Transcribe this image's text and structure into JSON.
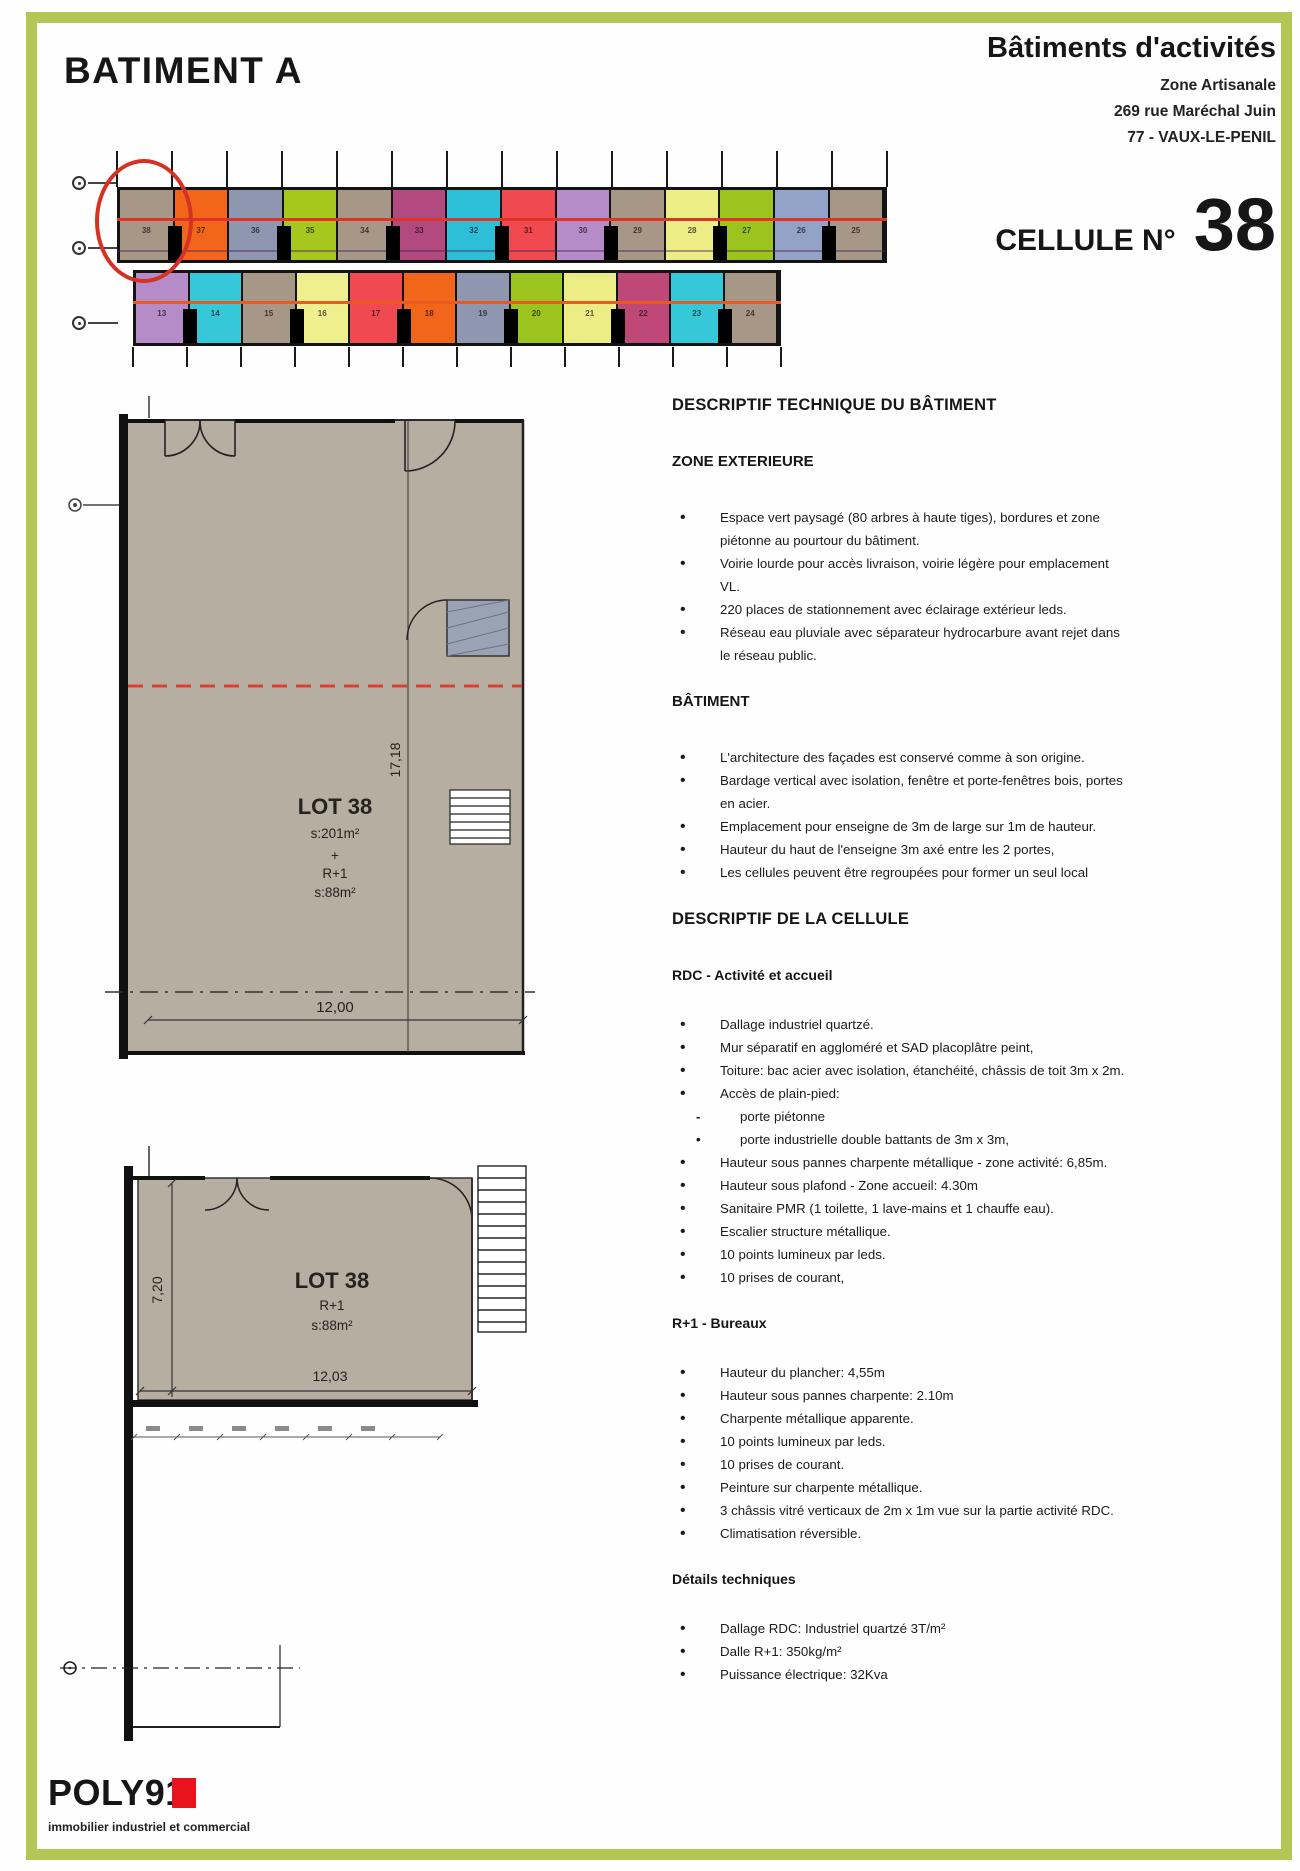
{
  "header": {
    "title_left": "BATIMENT A",
    "title_right": "Bâtiments d'activités",
    "address_lines": [
      "Zone Artisanale",
      "269 rue Maréchal Juin",
      "77 - VAUX-LE-PENIL"
    ],
    "cell_label": "CELLULE N°",
    "cell_number": "38"
  },
  "site_plan": {
    "highlighted_cell": "38",
    "highlight_color": "#d53125",
    "row1_line_color": "#e03226",
    "row2_line_color": "#ea5a1e",
    "rows": [
      {
        "cells": [
          {
            "num": "38",
            "color": "#a79786"
          },
          {
            "num": "37",
            "color": "#f2661c"
          },
          {
            "num": "36",
            "color": "#8e96b0"
          },
          {
            "num": "35",
            "color": "#a6c71d"
          },
          {
            "num": "34",
            "color": "#a79786"
          },
          {
            "num": "33",
            "color": "#b24a80"
          },
          {
            "num": "32",
            "color": "#2ebfd8"
          },
          {
            "num": "31",
            "color": "#f04a50"
          },
          {
            "num": "30",
            "color": "#b58cc8"
          },
          {
            "num": "29",
            "color": "#a79786"
          },
          {
            "num": "28",
            "color": "#eded85"
          },
          {
            "num": "27",
            "color": "#9cc41e"
          },
          {
            "num": "26",
            "color": "#93a3c8"
          },
          {
            "num": "25",
            "color": "#a79786"
          }
        ]
      },
      {
        "cells": [
          {
            "num": "13",
            "color": "#b58cc8"
          },
          {
            "num": "14",
            "color": "#36c8d8"
          },
          {
            "num": "15",
            "color": "#a79786"
          },
          {
            "num": "16",
            "color": "#efef90"
          },
          {
            "num": "17",
            "color": "#f04a50"
          },
          {
            "num": "18",
            "color": "#f2661c"
          },
          {
            "num": "19",
            "color": "#8e96b0"
          },
          {
            "num": "20",
            "color": "#9cc41e"
          },
          {
            "num": "21",
            "color": "#eded85"
          },
          {
            "num": "22",
            "color": "#c04878"
          },
          {
            "num": "23",
            "color": "#36c8d8"
          },
          {
            "num": "24",
            "color": "#a79786"
          }
        ]
      }
    ]
  },
  "plan_rdc": {
    "lot": "LOT 38",
    "area_rdc": "s:201m²",
    "plus": "+",
    "level": "R+1",
    "area_r1": "s:88m²",
    "dim_vertical": "17,18",
    "dim_horizontal": "12,00"
  },
  "plan_r1": {
    "lot": "LOT 38",
    "level": "R+1",
    "area": "s:88m²",
    "dim_vertical": "7,20",
    "dim_horizontal": "12,03"
  },
  "tech": {
    "title": "DESCRIPTIF TECHNIQUE DU BÂTIMENT",
    "zone_ext": {
      "title": "ZONE EXTERIEURE",
      "items": [
        "Espace vert paysagé (80 arbres à haute tiges), bordures et zone piétonne au pourtour du bâtiment.",
        "Voirie lourde pour accès livraison, voirie légère pour emplacement VL.",
        "220 places de stationnement avec éclairage extérieur leds.",
        "Réseau eau pluviale avec séparateur hydrocarbure avant rejet dans le réseau public."
      ]
    },
    "batiment": {
      "title": "BÂTIMENT",
      "items": [
        "L'architecture des façades est conservé comme à son origine.",
        "Bardage vertical avec isolation, fenêtre et porte-fenêtres bois, portes en acier.",
        "Emplacement pour enseigne de 3m de large sur 1m de hauteur.",
        "Hauteur du haut de l'enseigne 3m axé entre les 2 portes,",
        "Les cellules peuvent être regroupées pour former un seul local"
      ]
    }
  },
  "cellule": {
    "title": "DESCRIPTIF DE LA CELLULE",
    "rdc": {
      "title": "RDC - Activité et accueil",
      "items": [
        "Dallage industriel quartzé.",
        "Mur séparatif en aggloméré et SAD placoplâtre peint,",
        "Toiture: bac acier avec isolation, étanchéité, châssis de toit 3m x 2m.",
        "Accès de plain-pied:"
      ],
      "sub_items": [
        {
          "marker": "-",
          "text": "porte piétonne"
        },
        {
          "marker": "•",
          "text": "porte industrielle double battants de 3m x 3m,"
        }
      ],
      "items2": [
        "Hauteur sous pannes charpente métallique - zone activité: 6,85m.",
        "Hauteur sous plafond - Zone accueil: 4.30m",
        "Sanitaire PMR (1 toilette, 1 lave-mains et 1 chauffe eau).",
        "Escalier structure métallique.",
        "10 points lumineux par leds.",
        "10 prises de courant,"
      ]
    },
    "r1": {
      "title": "R+1 - Bureaux",
      "items": [
        "Hauteur du plancher: 4,55m",
        "Hauteur sous pannes charpente: 2.10m",
        "Charpente métallique apparente.",
        "10 points lumineux par leds.",
        "10 prises de courant.",
        "Peinture sur charpente métallique.",
        "3 châssis vitré verticaux de 2m x 1m vue sur la partie activité RDC.",
        "Climatisation réversible."
      ]
    },
    "details": {
      "title": "Détails techniques",
      "items": [
        "Dallage RDC: Industriel quartzé 3T/m²",
        "Dalle R+1: 350kg/m²",
        "Puissance électrique: 32Kva"
      ]
    }
  },
  "footer": {
    "brand": "POLY91",
    "tagline": "immobilier industriel et commercial",
    "accent_color": "#e8131c",
    "frame_color": "#b4c755"
  }
}
